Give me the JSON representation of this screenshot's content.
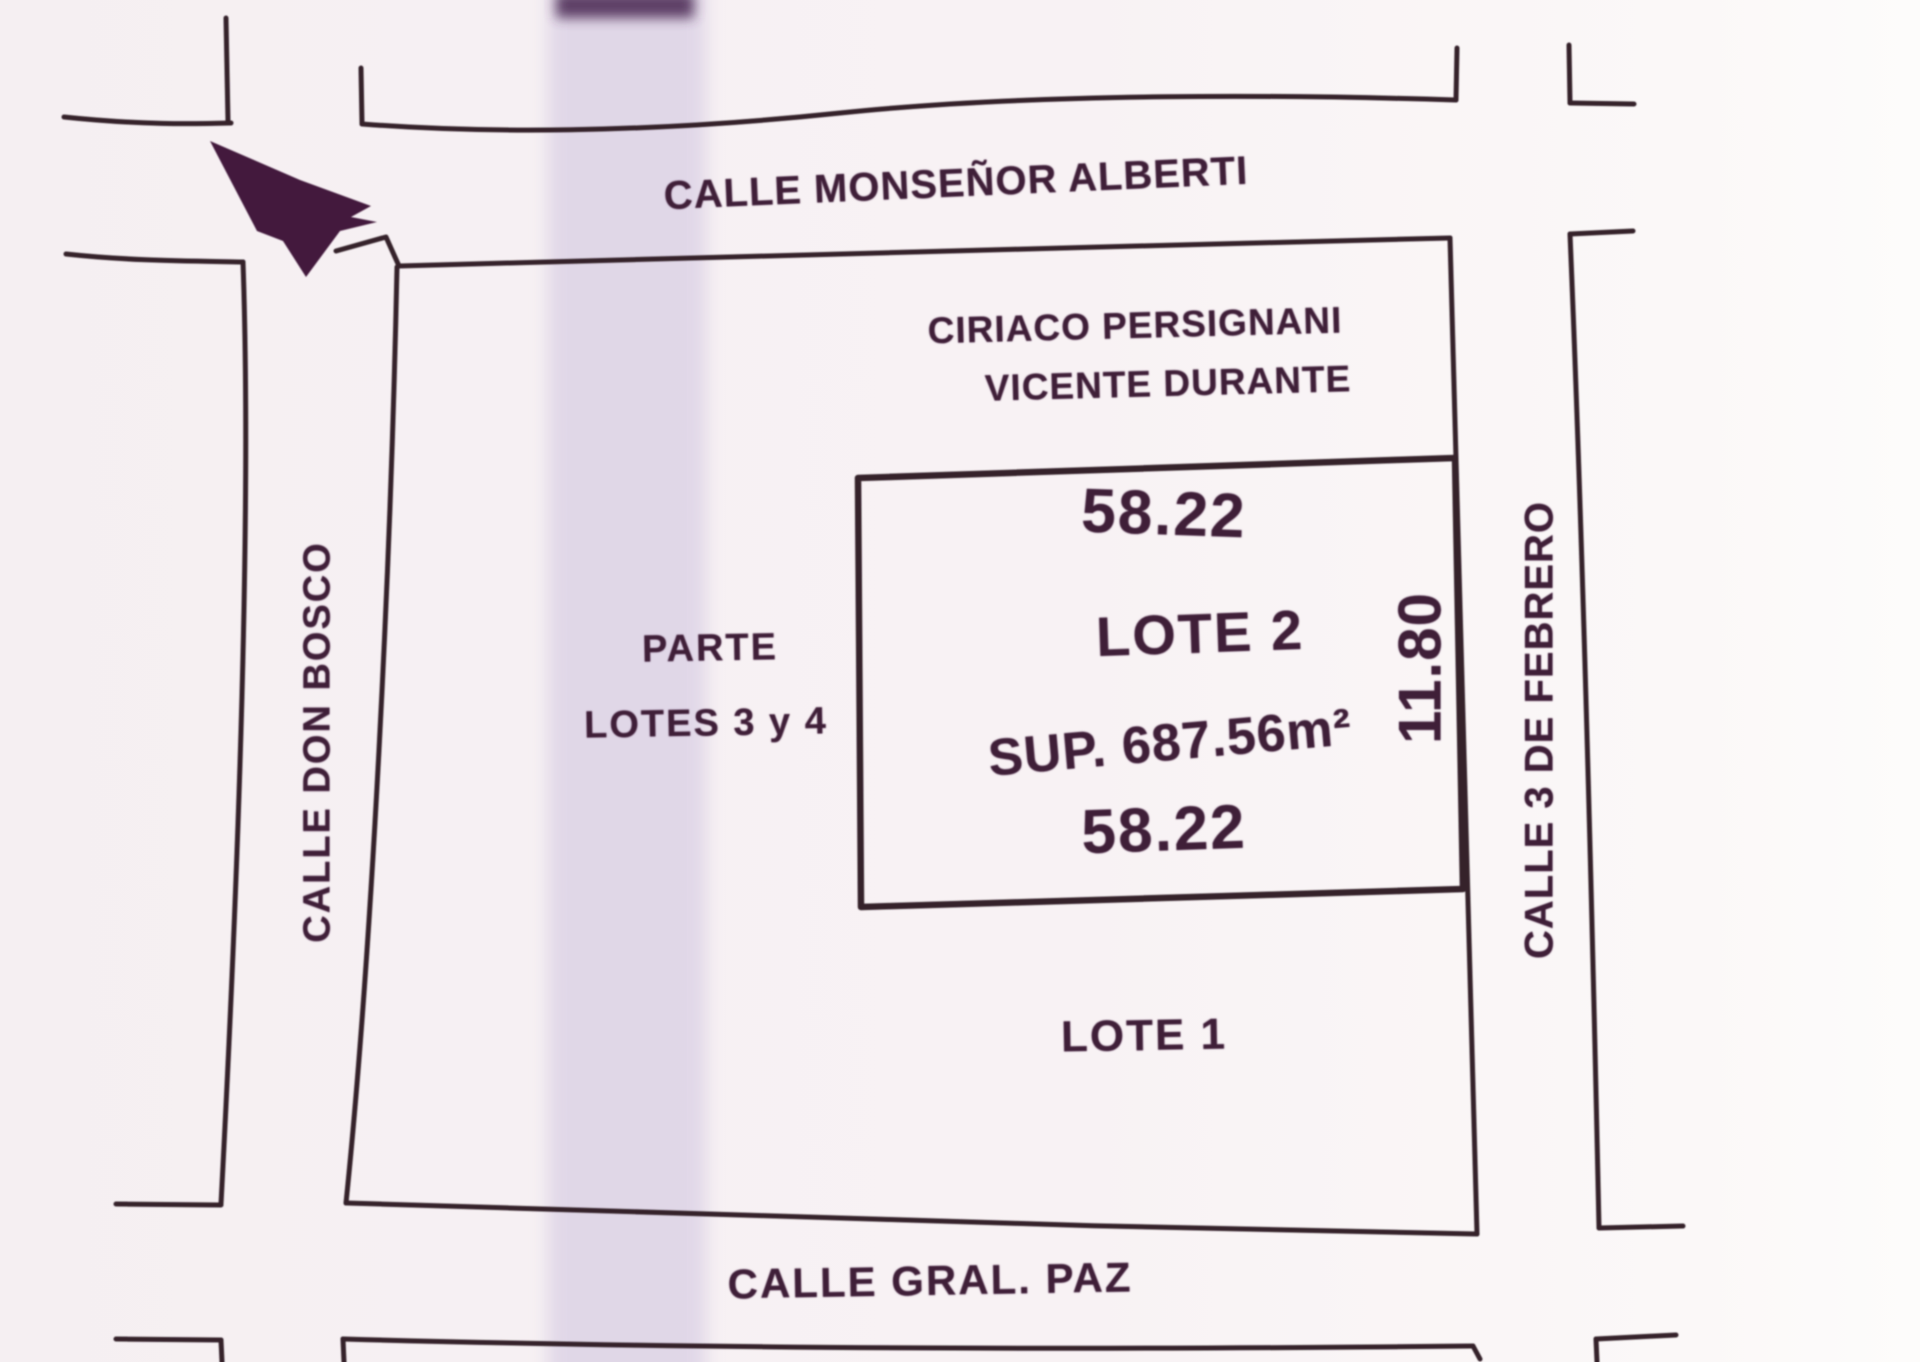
{
  "plan": {
    "streets": {
      "north": "CALLE MONSEÑOR ALBERTI",
      "south": "CALLE GRAL. PAZ",
      "west": "CALLE DON BOSCO",
      "east": "CALLE 3 DE FEBRERO"
    },
    "block": {
      "owners_line1": "CIRIACO PERSIGNANI",
      "owners_line2": "VICENTE DURANTE",
      "parte_line1": "PARTE",
      "parte_line2": "LOTES 3 y 4",
      "lote1_label": "LOTE 1"
    },
    "lot2": {
      "label": "LOTE 2",
      "surface": "SUP. 687.56m²",
      "width_top": "58.22",
      "width_bottom": "58.22",
      "depth_east": "11.80"
    },
    "icons": {
      "north_arrow": "north-arrow"
    },
    "colors": {
      "ink": "#35222a",
      "stamp": "#3f1f38",
      "paper": "#f7f1f3",
      "scan_band": "#d9cfe4",
      "band_cap": "#4f2f58",
      "arrow_fill": "#381031"
    }
  }
}
